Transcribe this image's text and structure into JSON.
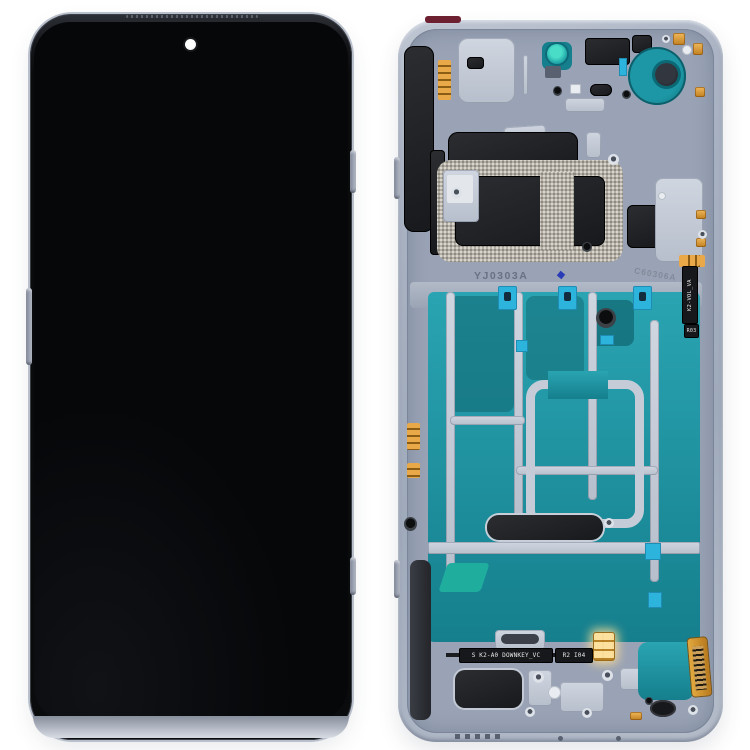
{
  "image": {
    "width": 750,
    "height": 750,
    "background": "#ffffff"
  },
  "markings": {
    "frame_code": "YJ0303A",
    "frame_code_secondary": "C60306A",
    "volume_flex_label": "K2-VOL_VA",
    "volume_flex_code": "R03",
    "downkey_flex_label": "S K2-A0 DOWNKEY_VC",
    "downkey_flex_code": "R2 I04"
  },
  "colors": {
    "background": "#ffffff",
    "frame_blue_gray": "#a9b2c2",
    "inner_plate": "#99a3b5",
    "screen_black": "#07080a",
    "graphite_teal": "#1b94a2",
    "adhesive_tape_cyan": "#2db4dd",
    "contact_gold": "#d89a3a",
    "gasket_speckle": "#b3afa6",
    "component_black": "#1d1f23",
    "stamp_text": "#5f6a7c"
  }
}
